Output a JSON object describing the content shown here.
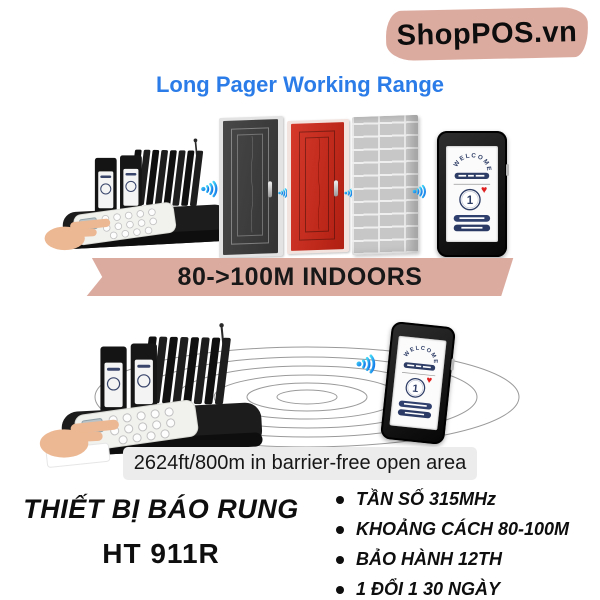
{
  "logo": {
    "text": "ShopPOS.vn",
    "bg_color": "#DCABA0"
  },
  "title": {
    "text": "Long Pager Working Range",
    "color": "#2B7CE8"
  },
  "icons": {
    "heart": "♥"
  },
  "scene1": {
    "indoor_banner": "80->100M INDOORS",
    "pager_screen": {
      "welcome": "WELCOME",
      "number": "1"
    }
  },
  "scene2": {
    "range_banner": "2624ft/800m in barrier-free open area",
    "pager_screen": {
      "welcome": "WELCOME",
      "number": "1"
    }
  },
  "product": {
    "name_line1": "THIẾT BỊ BÁO RUNG",
    "name_line2": "HT 911R"
  },
  "specs": {
    "items": [
      "TẦN SỐ 315MHz",
      "KHOẢNG CÁCH 80-100M",
      "BẢO HÀNH 12TH",
      "1 ĐỔI 1 30 NGÀY"
    ]
  },
  "colors": {
    "accent_tan": "#DCABA0",
    "title_blue": "#2B7CE8",
    "wifi_blue": "#1273E8",
    "wifi_cyan": "#43D7F7",
    "door_red": "#C2271B",
    "banner_gray": "#ECECEC"
  }
}
